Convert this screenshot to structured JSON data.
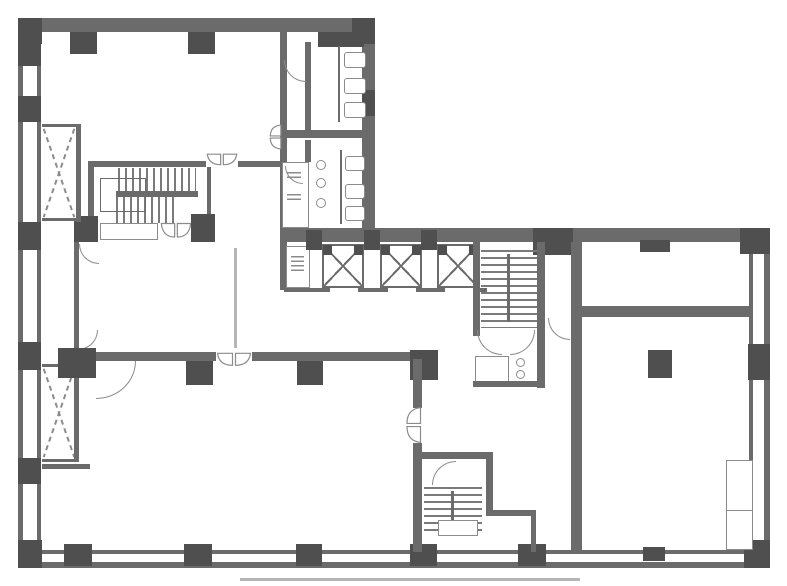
{
  "palette": {
    "wall": "#6b6b6b",
    "column": "#4f4f4f",
    "line": "#8b8b8b",
    "hatch": "#7a7a7a",
    "faint": "#b5b5b5",
    "bg": "#ffffff"
  },
  "canvas": {
    "width": 787,
    "height": 586
  },
  "plan": {
    "elements": [
      {
        "name": "outer-wall-top",
        "type": "wall",
        "x": 18,
        "y": 18,
        "w": 357,
        "h": 14
      },
      {
        "name": "outer-wall-left-outer",
        "type": "wall",
        "x": 18,
        "y": 18,
        "w": 5,
        "h": 550
      },
      {
        "name": "outer-wall-left-inner",
        "type": "wall",
        "x": 37,
        "y": 32,
        "w": 4,
        "h": 520
      },
      {
        "name": "upper-wing-right-wall",
        "type": "wall",
        "x": 362,
        "y": 32,
        "w": 13,
        "h": 200
      },
      {
        "name": "band-top-wall",
        "type": "wall",
        "x": 280,
        "y": 228,
        "w": 490,
        "h": 14
      },
      {
        "name": "outer-wall-right-outer",
        "type": "wall",
        "x": 764,
        "y": 228,
        "w": 6,
        "h": 340
      },
      {
        "name": "outer-wall-right-inner",
        "type": "wall",
        "x": 749,
        "y": 242,
        "w": 4,
        "h": 222
      },
      {
        "name": "outer-wall-bottom-outer",
        "type": "wall",
        "x": 18,
        "y": 562,
        "w": 752,
        "h": 6
      },
      {
        "name": "outer-wall-bottom-inner",
        "type": "wall",
        "x": 37,
        "y": 550,
        "w": 714,
        "h": 4
      },
      {
        "name": "corner-column-top-left",
        "type": "column",
        "x": 18,
        "y": 18,
        "w": 24,
        "h": 26
      },
      {
        "name": "top-wall-column",
        "type": "column",
        "x": 70,
        "y": 32,
        "w": 27,
        "h": 22
      },
      {
        "name": "top-wall-column",
        "type": "column",
        "x": 188,
        "y": 32,
        "w": 27,
        "h": 22
      },
      {
        "name": "top-wall-column",
        "type": "column",
        "x": 318,
        "y": 32,
        "w": 46,
        "h": 15
      },
      {
        "name": "corner-column-top-right-upper",
        "type": "column",
        "x": 352,
        "y": 18,
        "w": 23,
        "h": 26
      },
      {
        "name": "left-wall-column",
        "type": "column",
        "x": 18,
        "y": 42,
        "w": 23,
        "h": 24
      },
      {
        "name": "left-wall-column",
        "type": "column",
        "x": 18,
        "y": 96,
        "w": 23,
        "h": 26
      },
      {
        "name": "left-wall-column",
        "type": "column",
        "x": 18,
        "y": 222,
        "w": 23,
        "h": 28
      },
      {
        "name": "left-wall-column",
        "type": "column",
        "x": 18,
        "y": 342,
        "w": 23,
        "h": 28
      },
      {
        "name": "left-wall-column",
        "type": "column",
        "x": 18,
        "y": 458,
        "w": 23,
        "h": 26
      },
      {
        "name": "corner-column-bottom-left",
        "type": "column",
        "x": 18,
        "y": 540,
        "w": 24,
        "h": 28
      },
      {
        "name": "bottom-wall-column",
        "type": "column",
        "x": 64,
        "y": 544,
        "w": 28,
        "h": 22
      },
      {
        "name": "bottom-wall-column",
        "type": "column",
        "x": 184,
        "y": 544,
        "w": 28,
        "h": 22
      },
      {
        "name": "bottom-wall-column",
        "type": "column",
        "x": 296,
        "y": 544,
        "w": 26,
        "h": 22
      },
      {
        "name": "bottom-wall-column",
        "type": "column",
        "x": 410,
        "y": 544,
        "w": 27,
        "h": 22
      },
      {
        "name": "bottom-wall-column",
        "type": "column",
        "x": 518,
        "y": 544,
        "w": 28,
        "h": 22
      },
      {
        "name": "bottom-wall-column-small",
        "type": "column",
        "x": 643,
        "y": 547,
        "w": 22,
        "h": 14
      },
      {
        "name": "corner-column-bottom-right",
        "type": "column",
        "x": 744,
        "y": 540,
        "w": 26,
        "h": 28
      },
      {
        "name": "right-wall-column",
        "type": "column",
        "x": 748,
        "y": 344,
        "w": 22,
        "h": 36
      },
      {
        "name": "upper-wing-right-wall-column",
        "type": "column",
        "x": 362,
        "y": 90,
        "w": 13,
        "h": 26
      },
      {
        "name": "band-column",
        "type": "column",
        "x": 533,
        "y": 228,
        "w": 40,
        "h": 27
      },
      {
        "name": "room-a-notch-column",
        "type": "column",
        "x": 640,
        "y": 240,
        "w": 30,
        "h": 12
      },
      {
        "name": "corner-column-band-right",
        "type": "column",
        "x": 740,
        "y": 228,
        "w": 30,
        "h": 26
      },
      {
        "name": "toilet-block-left-wall",
        "type": "wall",
        "x": 280,
        "y": 32,
        "w": 7,
        "h": 198
      },
      {
        "name": "toilet-block-left-wall-lower",
        "type": "wall",
        "x": 280,
        "y": 228,
        "w": 7,
        "h": 62
      },
      {
        "name": "toilet-block-divider",
        "type": "wall",
        "x": 283,
        "y": 130,
        "w": 92,
        "h": 8
      },
      {
        "name": "toilet-partition-upper",
        "type": "wall",
        "x": 305,
        "y": 42,
        "w": 6,
        "h": 88
      },
      {
        "name": "toilet-partition-lower",
        "type": "wall",
        "x": 305,
        "y": 140,
        "w": 6,
        "h": 22
      },
      {
        "name": "wc-small-room",
        "type": "outline-thin",
        "x": 282,
        "y": 162,
        "w": 27,
        "h": 66
      },
      {
        "name": "sink-fixture",
        "type": "squiggle",
        "x": 287,
        "y": 172,
        "w": 14,
        "h": 9
      },
      {
        "name": "sink-fixture",
        "type": "squiggle",
        "x": 287,
        "y": 194,
        "w": 14,
        "h": 9
      },
      {
        "name": "toilet-fixture",
        "type": "fixture",
        "x": 344,
        "y": 52,
        "w": 22,
        "h": 16
      },
      {
        "name": "toilet-fixture",
        "type": "fixture",
        "x": 344,
        "y": 78,
        "w": 22,
        "h": 16
      },
      {
        "name": "toilet-fixture",
        "type": "fixture",
        "x": 344,
        "y": 102,
        "w": 22,
        "h": 16
      },
      {
        "name": "stall-partition",
        "type": "wall",
        "x": 338,
        "y": 46,
        "w": 2,
        "h": 76
      },
      {
        "name": "toilet-fixture",
        "type": "fixture",
        "x": 345,
        "y": 156,
        "w": 20,
        "h": 15
      },
      {
        "name": "toilet-fixture",
        "type": "fixture",
        "x": 345,
        "y": 184,
        "w": 20,
        "h": 15
      },
      {
        "name": "toilet-fixture",
        "type": "fixture",
        "x": 345,
        "y": 206,
        "w": 20,
        "h": 15
      },
      {
        "name": "stall-partition",
        "type": "wall",
        "x": 340,
        "y": 150,
        "w": 2,
        "h": 74
      },
      {
        "name": "urinal-fixture",
        "type": "round",
        "x": 316,
        "y": 160,
        "w": 10,
        "h": 10
      },
      {
        "name": "urinal-fixture",
        "type": "round",
        "x": 316,
        "y": 178,
        "w": 10,
        "h": 10
      },
      {
        "name": "urinal-fixture",
        "type": "round",
        "x": 316,
        "y": 198,
        "w": 10,
        "h": 10
      },
      {
        "name": "washroom-door-arc",
        "type": "door-arc",
        "x": 284,
        "y": 60,
        "w": 22,
        "h": 22,
        "rot": 0
      },
      {
        "name": "washroom-double-door",
        "type": "butterfly",
        "x": 262,
        "y": 130,
        "w": 26,
        "h": 14,
        "rot": 90
      },
      {
        "name": "wc-room-door-arc",
        "type": "door-arc",
        "x": 285,
        "y": 166,
        "w": 18,
        "h": 18,
        "rot": 0
      },
      {
        "name": "stair-enclosure-wall",
        "type": "wall",
        "x": 88,
        "y": 161,
        "w": 118,
        "h": 6
      },
      {
        "name": "stair-hall-double-door",
        "type": "butterfly",
        "x": 206,
        "y": 153,
        "w": 32,
        "h": 14,
        "rot": 0
      },
      {
        "name": "stair-enclosure-wall",
        "type": "wall",
        "x": 238,
        "y": 161,
        "w": 44,
        "h": 6
      },
      {
        "name": "stair-enclosure-wall-left",
        "type": "wall",
        "x": 88,
        "y": 161,
        "w": 6,
        "h": 80
      },
      {
        "name": "stair-enclosure-stub",
        "type": "wall",
        "x": 207,
        "y": 167,
        "w": 4,
        "h": 48
      },
      {
        "name": "upper-stair-treads",
        "type": "stair-v",
        "x": 118,
        "y": 168,
        "w": 78,
        "h": 25
      },
      {
        "name": "upper-stair-mid-rail",
        "type": "wall",
        "x": 116,
        "y": 191,
        "w": 82,
        "h": 6
      },
      {
        "name": "upper-stair-treads",
        "type": "stair-v",
        "x": 116,
        "y": 197,
        "w": 62,
        "h": 26
      },
      {
        "name": "upper-stair-handrail",
        "type": "rail",
        "x": 100,
        "y": 178,
        "w": 46,
        "h": 34
      },
      {
        "name": "lobby-column",
        "type": "column",
        "x": 74,
        "y": 216,
        "w": 24,
        "h": 26
      },
      {
        "name": "lobby-counter",
        "type": "outline-thin",
        "x": 100,
        "y": 223,
        "w": 58,
        "h": 17
      },
      {
        "name": "lobby-double-door",
        "type": "butterfly",
        "x": 160,
        "y": 222,
        "w": 32,
        "h": 18,
        "rot": 0
      },
      {
        "name": "lobby-column",
        "type": "column",
        "x": 191,
        "y": 214,
        "w": 24,
        "h": 28
      },
      {
        "name": "duct-x-brace-upper",
        "type": "xbrace",
        "x": 42,
        "y": 126,
        "w": 34,
        "h": 94
      },
      {
        "name": "duct-wall",
        "type": "wall",
        "x": 76,
        "y": 126,
        "w": 5,
        "h": 96
      },
      {
        "name": "duct-cap",
        "type": "wall",
        "x": 42,
        "y": 124,
        "w": 39,
        "h": 3
      },
      {
        "name": "duct-cap",
        "type": "wall",
        "x": 42,
        "y": 218,
        "w": 39,
        "h": 3
      },
      {
        "name": "duct-x-brace-lower",
        "type": "xbrace",
        "x": 42,
        "y": 366,
        "w": 34,
        "h": 94
      },
      {
        "name": "duct-wall",
        "type": "wall",
        "x": 74,
        "y": 366,
        "w": 5,
        "h": 96
      },
      {
        "name": "duct-cap",
        "type": "wall",
        "x": 42,
        "y": 364,
        "w": 37,
        "h": 3
      },
      {
        "name": "duct-cap",
        "type": "wall",
        "x": 42,
        "y": 459,
        "w": 37,
        "h": 3
      },
      {
        "name": "duct-stub",
        "type": "wall",
        "x": 42,
        "y": 464,
        "w": 48,
        "h": 5
      },
      {
        "name": "ev-hall-wall",
        "type": "wall",
        "x": 74,
        "y": 242,
        "w": 5,
        "h": 106
      },
      {
        "name": "ev-hall-door-arc",
        "type": "door-arc",
        "x": 79,
        "y": 244,
        "w": 20,
        "h": 20,
        "rot": 0
      },
      {
        "name": "ev-hall-door-arc",
        "type": "door-arc",
        "x": 78,
        "y": 330,
        "w": 20,
        "h": 20,
        "rot": 270
      },
      {
        "name": "lobby-partition-line",
        "type": "line",
        "x": 234,
        "y": 248,
        "w": 3,
        "h": 100
      },
      {
        "name": "pipe-shaft",
        "type": "outline-thin",
        "x": 286,
        "y": 246,
        "w": 24,
        "h": 42
      },
      {
        "name": "pipe-shaft-fixture",
        "type": "squiggle",
        "x": 291,
        "y": 256,
        "w": 13,
        "h": 16
      },
      {
        "name": "elevator-1",
        "type": "elevator",
        "x": 322,
        "y": 244,
        "w": 42,
        "h": 44
      },
      {
        "name": "elevator-2",
        "type": "elevator",
        "x": 380,
        "y": 244,
        "w": 42,
        "h": 44
      },
      {
        "name": "elevator-3",
        "type": "elevator",
        "x": 437,
        "y": 244,
        "w": 42,
        "h": 44
      },
      {
        "name": "ev-band-column",
        "type": "column",
        "x": 306,
        "y": 230,
        "w": 16,
        "h": 20
      },
      {
        "name": "ev-band-column",
        "type": "column",
        "x": 364,
        "y": 230,
        "w": 16,
        "h": 20
      },
      {
        "name": "ev-band-column",
        "type": "column",
        "x": 421,
        "y": 230,
        "w": 16,
        "h": 20
      },
      {
        "name": "ev-door-wall",
        "type": "wall",
        "x": 284,
        "y": 288,
        "w": 46,
        "h": 4
      },
      {
        "name": "ev-door-wall",
        "type": "wall",
        "x": 358,
        "y": 288,
        "w": 30,
        "h": 4
      },
      {
        "name": "ev-door-wall",
        "type": "wall",
        "x": 416,
        "y": 288,
        "w": 29,
        "h": 4
      },
      {
        "name": "ev-door-wall",
        "type": "wall",
        "x": 473,
        "y": 288,
        "w": 14,
        "h": 4
      },
      {
        "name": "mid-stair-wall-left",
        "type": "wall",
        "x": 473,
        "y": 242,
        "w": 7,
        "h": 94
      },
      {
        "name": "mid-stair-wall-right",
        "type": "wall",
        "x": 537,
        "y": 242,
        "w": 8,
        "h": 146
      },
      {
        "name": "mid-stair-treads",
        "type": "stair-h",
        "x": 481,
        "y": 250,
        "w": 56,
        "h": 78
      },
      {
        "name": "mid-stair-rail",
        "type": "wall",
        "x": 507,
        "y": 254,
        "w": 3,
        "h": 68
      },
      {
        "name": "mid-stair-door-arc",
        "type": "door-arc",
        "x": 477,
        "y": 330,
        "w": 25,
        "h": 25,
        "rot": 0
      },
      {
        "name": "mid-stair-door-arc",
        "type": "door-arc",
        "x": 510,
        "y": 330,
        "w": 25,
        "h": 25,
        "flip": true
      },
      {
        "name": "utility-room",
        "type": "outline-thin",
        "x": 475,
        "y": 356,
        "w": 34,
        "h": 26
      },
      {
        "name": "wc-fixture",
        "type": "round",
        "x": 516,
        "y": 358,
        "w": 9,
        "h": 9
      },
      {
        "name": "wc-fixture",
        "type": "round",
        "x": 516,
        "y": 370,
        "w": 9,
        "h": 9
      },
      {
        "name": "utility-block-wall",
        "type": "wall",
        "x": 473,
        "y": 381,
        "w": 72,
        "h": 6
      },
      {
        "name": "corridor-door-arc",
        "type": "door-arc",
        "x": 548,
        "y": 318,
        "w": 22,
        "h": 22,
        "rot": 0
      },
      {
        "name": "right-rooms-left-wall",
        "type": "wall",
        "x": 571,
        "y": 242,
        "w": 11,
        "h": 308
      },
      {
        "name": "right-rooms-divider-wall",
        "type": "wall",
        "x": 571,
        "y": 306,
        "w": 178,
        "h": 11
      },
      {
        "name": "room-b-column",
        "type": "column",
        "x": 648,
        "y": 350,
        "w": 24,
        "h": 28
      },
      {
        "name": "right-wall-closet",
        "type": "outline-thin",
        "x": 726,
        "y": 460,
        "w": 27,
        "h": 51
      },
      {
        "name": "right-wall-closet",
        "type": "outline-thin",
        "x": 726,
        "y": 510,
        "w": 27,
        "h": 40
      },
      {
        "name": "big-room-top-wall",
        "type": "wall",
        "x": 60,
        "y": 352,
        "w": 362,
        "h": 9
      },
      {
        "name": "big-room-door-opening",
        "type": "openwall",
        "x": 216,
        "y": 352,
        "w": 36,
        "h": 9
      },
      {
        "name": "big-room-double-door",
        "type": "butterfly",
        "x": 216,
        "y": 352,
        "w": 36,
        "h": 16,
        "rot": 0
      },
      {
        "name": "big-room-door-arc",
        "type": "door-arc",
        "x": 96,
        "y": 361,
        "w": 40,
        "h": 38,
        "flip": true
      },
      {
        "name": "big-room-column",
        "type": "column",
        "x": 58,
        "y": 348,
        "w": 38,
        "h": 30
      },
      {
        "name": "big-room-column",
        "type": "column",
        "x": 186,
        "y": 361,
        "w": 27,
        "h": 24
      },
      {
        "name": "big-room-column",
        "type": "column",
        "x": 297,
        "y": 361,
        "w": 26,
        "h": 24
      },
      {
        "name": "big-room-corner-column",
        "type": "column",
        "x": 410,
        "y": 350,
        "w": 28,
        "h": 30
      },
      {
        "name": "big-room-right-wall",
        "type": "wall",
        "x": 413,
        "y": 359,
        "w": 9,
        "h": 49
      },
      {
        "name": "hall-double-door",
        "type": "butterfly",
        "x": 394,
        "y": 416,
        "w": 38,
        "h": 18,
        "rot": 90
      },
      {
        "name": "big-room-right-wall",
        "type": "wall",
        "x": 413,
        "y": 443,
        "w": 9,
        "h": 12
      },
      {
        "name": "bottom-stair-top-wall",
        "type": "wall",
        "x": 413,
        "y": 452,
        "w": 80,
        "h": 7
      },
      {
        "name": "bottom-stair-left-wall",
        "type": "wall",
        "x": 413,
        "y": 459,
        "w": 9,
        "h": 93
      },
      {
        "name": "bottom-stair-right-wall",
        "type": "wall",
        "x": 486,
        "y": 459,
        "w": 7,
        "h": 56
      },
      {
        "name": "bottom-stair-door-arc",
        "type": "door-arc",
        "x": 432,
        "y": 461,
        "w": 24,
        "h": 24,
        "rot": 90
      },
      {
        "name": "bottom-stair-treads",
        "type": "stair-h",
        "x": 424,
        "y": 487,
        "w": 58,
        "h": 46
      },
      {
        "name": "bottom-stair-rail",
        "type": "wall",
        "x": 451,
        "y": 491,
        "w": 3,
        "h": 38
      },
      {
        "name": "bottom-stair-landing",
        "type": "outline-thin",
        "x": 438,
        "y": 520,
        "w": 40,
        "h": 16
      },
      {
        "name": "vestibule-top-wall",
        "type": "wall",
        "x": 486,
        "y": 510,
        "w": 50,
        "h": 6
      },
      {
        "name": "vestibule-right-wall",
        "type": "wall",
        "x": 531,
        "y": 516,
        "w": 5,
        "h": 36
      },
      {
        "name": "print-artifact-line",
        "type": "line",
        "x": 240,
        "y": 578,
        "w": 340,
        "h": 3
      }
    ]
  }
}
